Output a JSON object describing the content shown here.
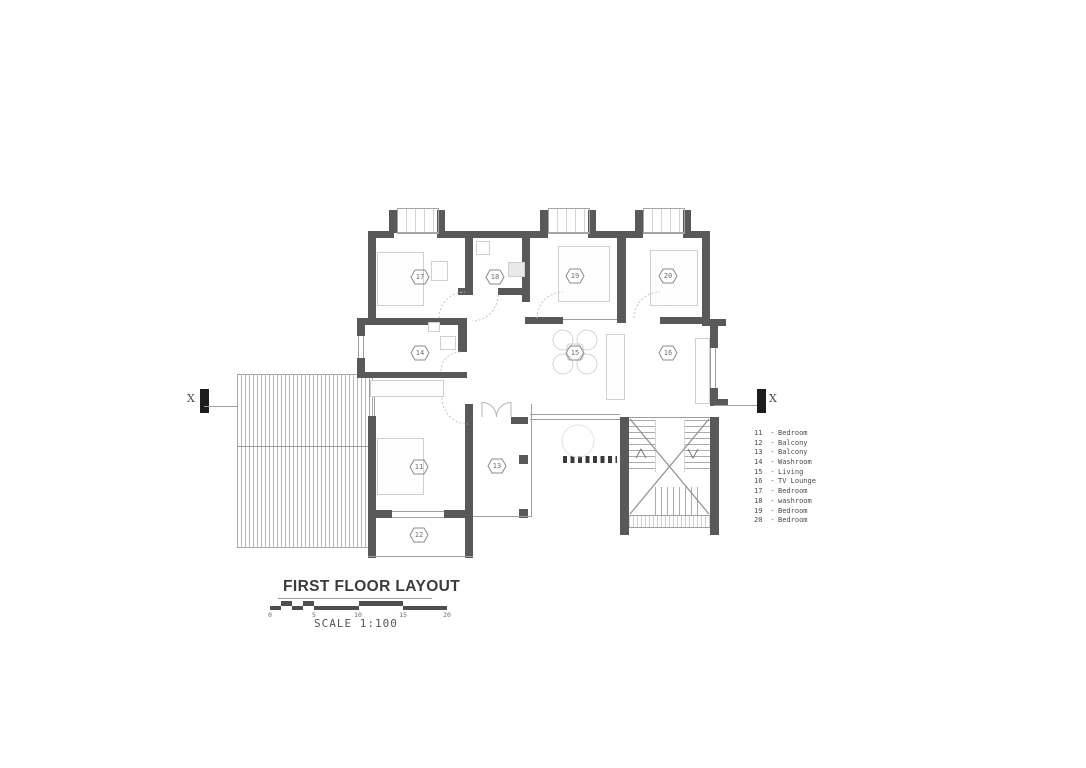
{
  "colors": {
    "wall": "#58595b",
    "thin_line": "#9e9e9e",
    "text": "#3b3b3c",
    "scale_bar": "#4f4f51"
  },
  "plan": {
    "markers": {
      "r11": "11",
      "r12": "12",
      "r13": "13",
      "r14": "14",
      "r15": "15",
      "r16": "16",
      "r17": "17",
      "r18": "18",
      "r19": "19",
      "r20": "20"
    }
  },
  "section": {
    "left": "X",
    "right": "X"
  },
  "legend": {
    "separator": "-",
    "items": [
      {
        "num": "11",
        "name": "Bedroom"
      },
      {
        "num": "12",
        "name": "Balcony"
      },
      {
        "num": "13",
        "name": "Balcony"
      },
      {
        "num": "14",
        "name": "Washroom"
      },
      {
        "num": "15",
        "name": "Living"
      },
      {
        "num": "16",
        "name": "TV Lounge"
      },
      {
        "num": "17",
        "name": "Bedroom"
      },
      {
        "num": "18",
        "name": "washroom"
      },
      {
        "num": "19",
        "name": "Bedroom"
      },
      {
        "num": "20",
        "name": "Bedroom"
      }
    ]
  },
  "title_block": {
    "title": "FIRST FLOOR LAYOUT",
    "scale_label": "SCALE 1:100",
    "ticks": [
      "0",
      "5",
      "10",
      "15",
      "20"
    ]
  }
}
